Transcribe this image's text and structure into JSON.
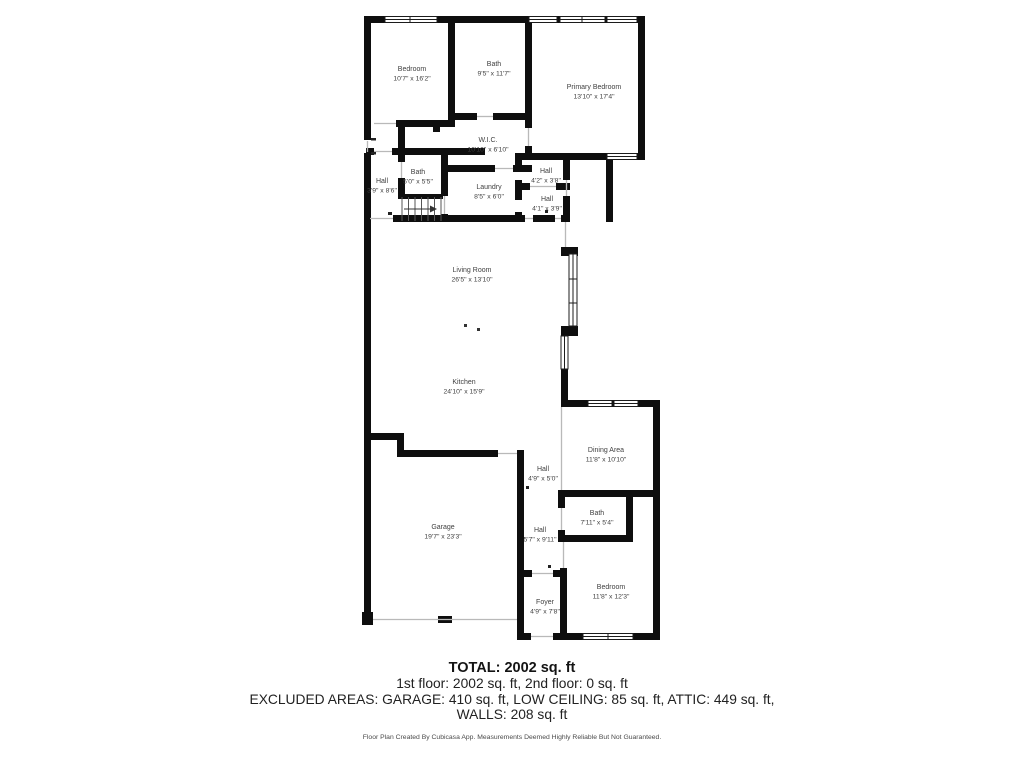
{
  "plan": {
    "rooms": [
      {
        "id": "bedroom-top",
        "name": "Bedroom",
        "dims": "10'7\" x 16'2\"",
        "cx": 412,
        "cy": 71
      },
      {
        "id": "bath-top",
        "name": "Bath",
        "dims": "9'5\" x 11'7\"",
        "cx": 494,
        "cy": 66
      },
      {
        "id": "primary-bedroom",
        "name": "Primary Bedroom",
        "dims": "13'10\" x 17'4\"",
        "cx": 594,
        "cy": 89
      },
      {
        "id": "wic",
        "name": "W.I.C.",
        "dims": "10'10\" x 6'10\"",
        "cx": 488,
        "cy": 142
      },
      {
        "id": "bath-mid",
        "name": "Bath",
        "dims": "5'0\" x 5'5\"",
        "cx": 418,
        "cy": 174
      },
      {
        "id": "hall-upper-left",
        "name": "Hall",
        "dims": "3'9\" x 8'6\"",
        "cx": 382,
        "cy": 183
      },
      {
        "id": "laundry",
        "name": "Laundry",
        "dims": "8'5\" x 6'0\"",
        "cx": 489,
        "cy": 189
      },
      {
        "id": "hall-42",
        "name": "Hall",
        "dims": "4'2\" x 3'8\"",
        "cx": 546,
        "cy": 173
      },
      {
        "id": "hall-41",
        "name": "Hall",
        "dims": "4'1\" x 3'9\"",
        "cx": 547,
        "cy": 201
      },
      {
        "id": "living-room",
        "name": "Living Room",
        "dims": "26'5\" x 13'10\"",
        "cx": 472,
        "cy": 272
      },
      {
        "id": "kitchen",
        "name": "Kitchen",
        "dims": "24'10\" x 15'9\"",
        "cx": 464,
        "cy": 384
      },
      {
        "id": "dining-area",
        "name": "Dining Area",
        "dims": "11'8\" x 10'10\"",
        "cx": 606,
        "cy": 452
      },
      {
        "id": "hall-49",
        "name": "Hall",
        "dims": "4'9\" x 5'0\"",
        "cx": 543,
        "cy": 471
      },
      {
        "id": "garage",
        "name": "Garage",
        "dims": "19'7\" x 23'3\"",
        "cx": 443,
        "cy": 529
      },
      {
        "id": "hall-57",
        "name": "Hall",
        "dims": "5'7\" x 9'11\"",
        "cx": 540,
        "cy": 532
      },
      {
        "id": "bath-lower",
        "name": "Bath",
        "dims": "7'11\" x 5'4\"",
        "cx": 597,
        "cy": 515
      },
      {
        "id": "bedroom-lower",
        "name": "Bedroom",
        "dims": "11'8\" x 12'3\"",
        "cx": 611,
        "cy": 589
      },
      {
        "id": "foyer",
        "name": "Foyer",
        "dims": "4'9\" x 7'8\"",
        "cx": 545,
        "cy": 604
      }
    ]
  },
  "summary": {
    "total": "TOTAL: 2002 sq. ft",
    "floors": "1st floor: 2002 sq. ft, 2nd floor: 0 sq. ft",
    "excluded": "EXCLUDED AREAS: GARAGE: 410 sq. ft, LOW CEILING: 85 sq. ft, ATTIC: 449 sq. ft,",
    "walls": "WALLS: 208 sq. ft",
    "disclaimer": "Floor Plan Created By Cubicasa App. Measurements Deemed Highly Reliable But Not Guaranteed."
  },
  "colors": {
    "wall": "#0e0e0e",
    "label_text": "#3f3f3f",
    "opening_line": "#b9b9b9"
  }
}
